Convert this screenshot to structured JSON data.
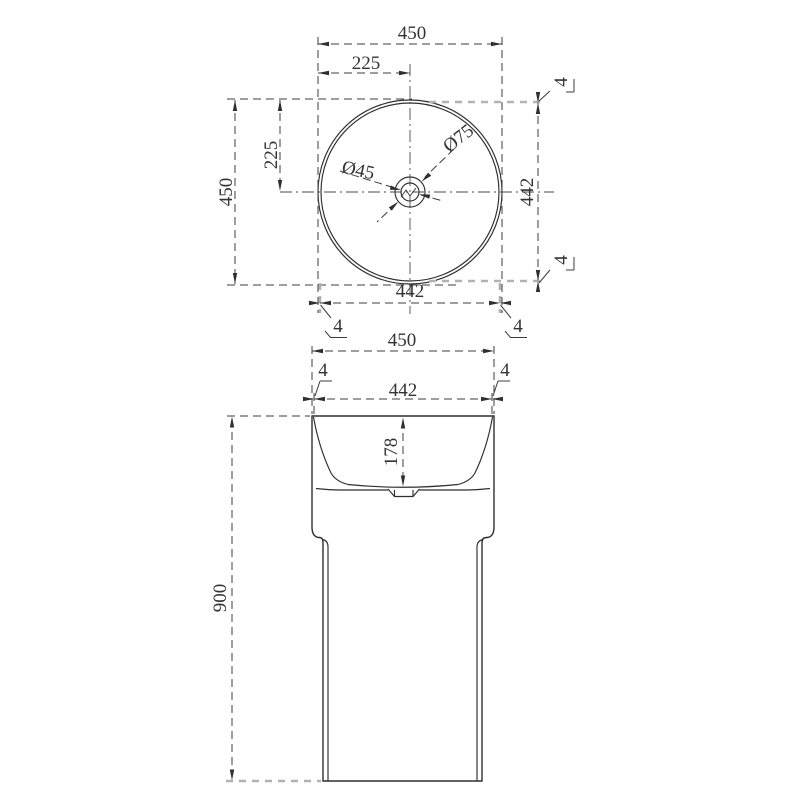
{
  "top_view": {
    "width_total": "450",
    "width_half": "225",
    "height_total": "450",
    "height_half": "225",
    "inner_height": "442",
    "inner_width": "442",
    "drain_diameter": "Ø45",
    "overflow_diameter": "Ø75",
    "rim_top_right": "4",
    "rim_bottom_right_v": "4",
    "rim_bottom_left": "4",
    "rim_bottom_right_h": "4"
  },
  "front_view": {
    "width_total": "450",
    "inner_width": "442",
    "wall_left": "4",
    "wall_right": "4",
    "basin_depth": "178",
    "overall_height": "900"
  },
  "colors": {
    "line": "#2f2f2f",
    "dim_line": "#3c3c3c",
    "auxiliary_gray": "#b2b2b2",
    "background": "#ffffff"
  }
}
